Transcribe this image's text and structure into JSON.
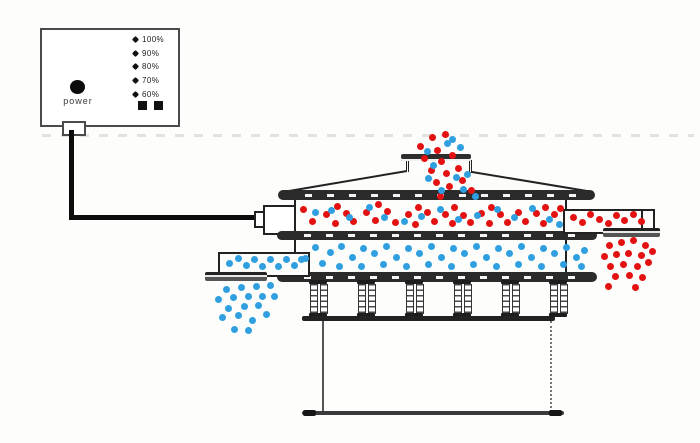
{
  "control_panel": {
    "power_label": "power",
    "levels": [
      {
        "label": "100%"
      },
      {
        "label": "90%"
      },
      {
        "label": "80%"
      },
      {
        "label": "70%"
      },
      {
        "label": "60%"
      }
    ],
    "square_button_count": 2
  },
  "colors": {
    "particle_red": "#e31111",
    "particle_blue": "#2f9fe0",
    "line": "#222222",
    "panel_border": "#4a4a4a"
  },
  "particles": {
    "inlet_stream": {
      "red": [
        [
          432,
          137
        ],
        [
          445,
          134
        ],
        [
          420,
          146
        ],
        [
          437,
          150
        ],
        [
          424,
          158
        ],
        [
          441,
          161
        ],
        [
          452,
          155
        ],
        [
          431,
          170
        ],
        [
          446,
          173
        ],
        [
          458,
          168
        ],
        [
          436,
          182
        ],
        [
          449,
          186
        ],
        [
          462,
          180
        ],
        [
          471,
          190
        ],
        [
          440,
          196
        ]
      ],
      "blue": [
        [
          452,
          139
        ],
        [
          460,
          147
        ],
        [
          427,
          151
        ],
        [
          447,
          143
        ],
        [
          433,
          165
        ],
        [
          456,
          177
        ],
        [
          467,
          174
        ],
        [
          428,
          178
        ],
        [
          441,
          190
        ],
        [
          463,
          189
        ],
        [
          475,
          196
        ]
      ]
    },
    "upper_deck": {
      "red": [
        [
          303,
          209
        ],
        [
          312,
          221
        ],
        [
          326,
          214
        ],
        [
          335,
          223
        ],
        [
          337,
          206
        ],
        [
          346,
          213
        ],
        [
          353,
          221
        ],
        [
          366,
          212
        ],
        [
          375,
          220
        ],
        [
          378,
          204
        ],
        [
          387,
          211
        ],
        [
          395,
          222
        ],
        [
          408,
          214
        ],
        [
          418,
          207
        ],
        [
          415,
          224
        ],
        [
          427,
          212
        ],
        [
          434,
          221
        ],
        [
          445,
          214
        ],
        [
          454,
          207
        ],
        [
          452,
          223
        ],
        [
          463,
          215
        ],
        [
          470,
          222
        ],
        [
          481,
          213
        ],
        [
          491,
          207
        ],
        [
          489,
          223
        ],
        [
          500,
          214
        ],
        [
          507,
          222
        ],
        [
          518,
          212
        ],
        [
          525,
          221
        ],
        [
          536,
          213
        ],
        [
          545,
          207
        ],
        [
          543,
          223
        ],
        [
          554,
          214
        ],
        [
          560,
          208
        ]
      ],
      "blue": [
        [
          315,
          212
        ],
        [
          331,
          210
        ],
        [
          349,
          217
        ],
        [
          369,
          207
        ],
        [
          384,
          217
        ],
        [
          404,
          221
        ],
        [
          421,
          216
        ],
        [
          440,
          209
        ],
        [
          458,
          219
        ],
        [
          477,
          215
        ],
        [
          497,
          209
        ],
        [
          514,
          217
        ],
        [
          532,
          208
        ],
        [
          549,
          219
        ],
        [
          559,
          224
        ]
      ]
    },
    "right_outlet": {
      "red": [
        [
          573,
          217
        ],
        [
          582,
          222
        ],
        [
          590,
          214
        ],
        [
          599,
          219
        ],
        [
          608,
          223
        ],
        [
          616,
          215
        ],
        [
          624,
          220
        ],
        [
          633,
          214
        ],
        [
          641,
          221
        ]
      ]
    },
    "right_discharge": {
      "red": [
        [
          609,
          245
        ],
        [
          621,
          242
        ],
        [
          633,
          240
        ],
        [
          645,
          245
        ],
        [
          604,
          256
        ],
        [
          616,
          254
        ],
        [
          628,
          253
        ],
        [
          641,
          255
        ],
        [
          652,
          251
        ],
        [
          610,
          266
        ],
        [
          623,
          264
        ],
        [
          637,
          266
        ],
        [
          648,
          262
        ],
        [
          615,
          276
        ],
        [
          629,
          275
        ],
        [
          642,
          277
        ],
        [
          608,
          286
        ],
        [
          635,
          287
        ]
      ]
    },
    "lower_deck": {
      "blue": [
        [
          305,
          258
        ],
        [
          315,
          247
        ],
        [
          322,
          263
        ],
        [
          330,
          252
        ],
        [
          341,
          246
        ],
        [
          339,
          266
        ],
        [
          352,
          257
        ],
        [
          363,
          248
        ],
        [
          361,
          266
        ],
        [
          374,
          253
        ],
        [
          386,
          246
        ],
        [
          383,
          264
        ],
        [
          396,
          257
        ],
        [
          408,
          248
        ],
        [
          406,
          266
        ],
        [
          419,
          253
        ],
        [
          431,
          246
        ],
        [
          428,
          264
        ],
        [
          441,
          257
        ],
        [
          453,
          248
        ],
        [
          451,
          266
        ],
        [
          464,
          253
        ],
        [
          476,
          246
        ],
        [
          473,
          264
        ],
        [
          486,
          257
        ],
        [
          498,
          248
        ],
        [
          496,
          266
        ],
        [
          509,
          253
        ],
        [
          521,
          246
        ],
        [
          518,
          264
        ],
        [
          531,
          257
        ],
        [
          543,
          248
        ],
        [
          541,
          266
        ],
        [
          554,
          253
        ],
        [
          566,
          247
        ],
        [
          563,
          264
        ],
        [
          576,
          257
        ],
        [
          584,
          250
        ],
        [
          581,
          266
        ]
      ]
    },
    "left_outlet": {
      "blue": [
        [
          229,
          263
        ],
        [
          238,
          258
        ],
        [
          246,
          265
        ],
        [
          254,
          259
        ],
        [
          262,
          266
        ],
        [
          270,
          259
        ],
        [
          278,
          266
        ],
        [
          286,
          259
        ],
        [
          294,
          265
        ],
        [
          301,
          259
        ]
      ]
    },
    "left_discharge": {
      "blue": [
        [
          226,
          289
        ],
        [
          241,
          287
        ],
        [
          256,
          286
        ],
        [
          270,
          285
        ],
        [
          218,
          299
        ],
        [
          233,
          297
        ],
        [
          248,
          296
        ],
        [
          262,
          296
        ],
        [
          228,
          308
        ],
        [
          244,
          306
        ],
        [
          258,
          305
        ],
        [
          222,
          317
        ],
        [
          238,
          315
        ],
        [
          252,
          320
        ],
        [
          234,
          329
        ],
        [
          248,
          330
        ],
        [
          266,
          314
        ],
        [
          274,
          296
        ]
      ]
    }
  }
}
